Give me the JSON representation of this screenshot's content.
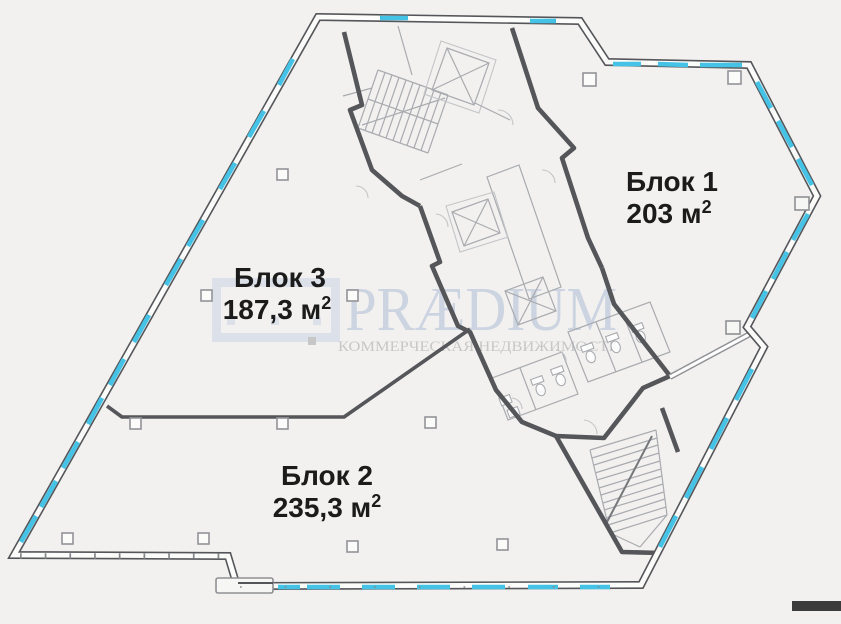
{
  "blocks": [
    {
      "name": "Блок 1",
      "area": "203 м",
      "area_sup": "2"
    },
    {
      "name": "Блок 2",
      "area": "235,3 м",
      "area_sup": "2"
    },
    {
      "name": "Блок 3",
      "area": "187,3 м",
      "area_sup": "2"
    }
  ],
  "watermark": {
    "brand": "PRÆDIUM",
    "tagline": "КОММЕРЧЕСКАЯ НЕДВИЖИМОСТЬ"
  },
  "colors": {
    "background": "#f2f1ef",
    "wall": "#55565a",
    "window": "#45c3e6",
    "line": "#a9abb0",
    "line_light": "#c3c5c9",
    "label": "#1b1b1b",
    "watermark_blue": "#dbe0e9",
    "watermark_blue_text": "#ccd4e1",
    "watermark_gray": "#c7c7c7"
  }
}
